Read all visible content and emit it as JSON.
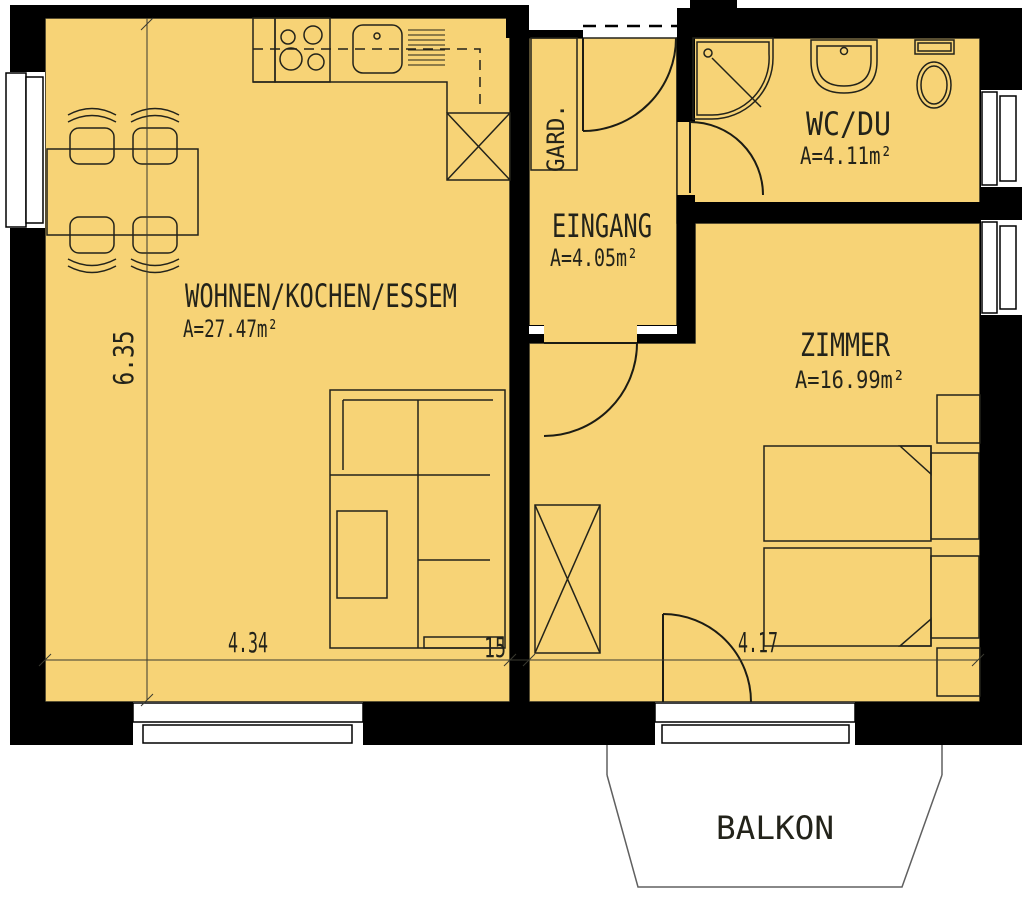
{
  "plan": {
    "title": "apartment-floor-plan",
    "colors": {
      "floor": "#F7D376",
      "wall": "#000000",
      "line": "#23231a",
      "background": "#ffffff"
    },
    "rooms": [
      {
        "name": "WOHNEN/KOCHEN/ESSEM",
        "area": "A=27.47m²"
      },
      {
        "name": "EINGANG",
        "area": "A=4.05m²"
      },
      {
        "name": "WC/DU",
        "area": "A=4.11m²"
      },
      {
        "name": "ZIMMER",
        "area": "A=16.99m²"
      },
      {
        "name": "GARD."
      },
      {
        "name": "BALKON"
      }
    ],
    "dimensions": {
      "living_width": "4.34",
      "wall_thickness": "15",
      "zimmer_width": "4.17",
      "living_height": "6.35"
    }
  }
}
